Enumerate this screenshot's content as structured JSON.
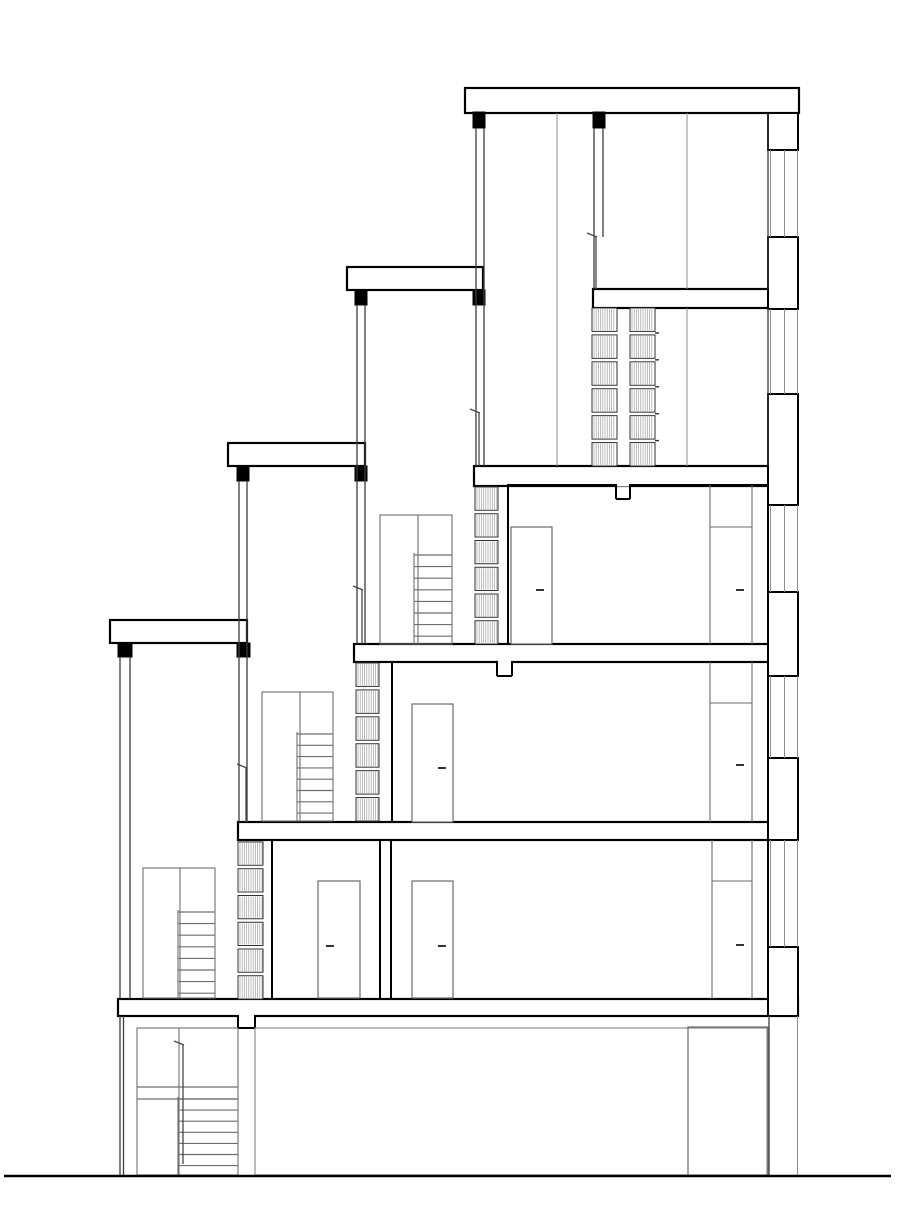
{
  "drawing": {
    "canvas": {
      "width": 912,
      "height": 1232,
      "background": "#ffffff"
    },
    "palette": {
      "heavy": "#000000",
      "medium": "#3c3c3c",
      "light": "#8e8e8e",
      "door": "#6b6b6b",
      "stair": "#6f6f6f",
      "hatch": "#9a9a9a",
      "hatch_frame": "#2f2f2f",
      "handle": "#333333",
      "rail": "#474747"
    },
    "ground_line": {
      "x1": 4,
      "x2": 891,
      "y": 1176,
      "weight": 2.6
    },
    "slabs": [
      {
        "name": "roof-slab",
        "x": 465,
        "y": 88,
        "w": 334,
        "h": 25
      },
      {
        "name": "floor-slab-4",
        "x": 593,
        "y": 289,
        "w": 177,
        "h": 19
      },
      {
        "name": "floor-slab-3",
        "x": 474,
        "y": 466,
        "w": 296,
        "h": 20
      },
      {
        "name": "floor-slab-2",
        "x": 354,
        "y": 644,
        "w": 416,
        "h": 18
      },
      {
        "name": "floor-slab-1",
        "x": 238,
        "y": 822,
        "w": 532,
        "h": 18
      },
      {
        "name": "floor-slab-0",
        "x": 118,
        "y": 999,
        "w": 680,
        "h": 17
      }
    ],
    "parapet_caps": [
      {
        "name": "terrace-parapet-2",
        "x": 347,
        "y": 267,
        "w": 136,
        "h": 23
      },
      {
        "name": "terrace-parapet-3",
        "x": 228,
        "y": 443,
        "w": 137,
        "h": 23
      },
      {
        "name": "terrace-parapet-4",
        "x": 110,
        "y": 620,
        "w": 137,
        "h": 23
      }
    ],
    "posts": [
      {
        "x": 473,
        "y": 112,
        "w": 12,
        "h": 16
      },
      {
        "x": 593,
        "y": 112,
        "w": 12,
        "h": 16
      },
      {
        "x": 355,
        "y": 290,
        "w": 12,
        "h": 15
      },
      {
        "x": 473,
        "y": 290,
        "w": 12,
        "h": 15
      },
      {
        "x": 237,
        "y": 466,
        "w": 12,
        "h": 15
      },
      {
        "x": 355,
        "y": 466,
        "w": 12,
        "h": 15
      },
      {
        "x": 118,
        "y": 643,
        "w": 14,
        "h": 14
      },
      {
        "x": 237,
        "y": 643,
        "w": 13,
        "h": 14
      }
    ],
    "wall_lines": [
      {
        "x": 476,
        "y1": 128,
        "y2": 466,
        "c": "medium"
      },
      {
        "x": 484,
        "y1": 128,
        "y2": 466,
        "c": "medium"
      },
      {
        "x": 594,
        "y1": 128,
        "y2": 289,
        "c": "medium"
      },
      {
        "x": 603,
        "y1": 128,
        "y2": 237,
        "c": "medium"
      },
      {
        "x": 357,
        "y1": 305,
        "y2": 644,
        "c": "medium"
      },
      {
        "x": 365,
        "y1": 305,
        "y2": 644,
        "c": "medium"
      },
      {
        "x": 239,
        "y1": 481,
        "y2": 822,
        "c": "medium"
      },
      {
        "x": 247,
        "y1": 481,
        "y2": 822,
        "c": "medium"
      },
      {
        "x": 120,
        "y1": 657,
        "y2": 999,
        "c": "medium"
      },
      {
        "x": 130,
        "y1": 657,
        "y2": 999,
        "c": "medium"
      },
      {
        "x": 120,
        "y1": 1016,
        "y2": 1175,
        "c": "medium"
      },
      {
        "x": 123.5,
        "y1": 1016,
        "y2": 1175,
        "c": "medium"
      },
      {
        "x": 769,
        "y1": 1016,
        "y2": 1175,
        "c": "medium"
      },
      {
        "x": 797.5,
        "y1": 1016,
        "y2": 1175,
        "c": "light"
      },
      {
        "x": 557,
        "y1": 113,
        "y2": 466,
        "c": "light"
      },
      {
        "x": 687,
        "y1": 113,
        "y2": 289,
        "c": "light"
      },
      {
        "x": 687,
        "y1": 308,
        "y2": 466,
        "c": "light"
      },
      {
        "x": 768,
        "y1": 113,
        "y2": 289,
        "c": "medium"
      },
      {
        "x": 768,
        "y1": 308,
        "y2": 466,
        "c": "medium"
      }
    ],
    "facade": {
      "x": 768,
      "w": 30,
      "blocks": [
        {
          "y1": 113,
          "y2": 150
        },
        {
          "y1": 237,
          "y2": 309
        },
        {
          "y1": 394,
          "y2": 505
        },
        {
          "y1": 592,
          "y2": 676
        },
        {
          "y1": 758,
          "y2": 840
        },
        {
          "y1": 947,
          "y2": 1016
        }
      ],
      "windows": [
        {
          "y1": 150,
          "y2": 237
        },
        {
          "y1": 309,
          "y2": 394
        },
        {
          "y1": 505,
          "y2": 592
        },
        {
          "y1": 676,
          "y2": 758
        },
        {
          "y1": 840,
          "y2": 947
        }
      ],
      "window_line_x": [
        770.5,
        784.5,
        797.5
      ]
    },
    "room_boxes": [
      {
        "name": "room-outline-l3",
        "x": 508,
        "y": 485,
        "w": 260,
        "h": 159,
        "notch": {
          "x": 616,
          "w": 14,
          "d": 14
        }
      },
      {
        "name": "room-outline-l2",
        "x": 392,
        "y": 662,
        "w": 376,
        "h": 160,
        "notch": {
          "x": 497,
          "w": 15,
          "d": 14
        }
      },
      {
        "name": "room-outline-l1-left",
        "x": 272,
        "y": 840,
        "w": 108,
        "h": 159
      },
      {
        "name": "room-outline-l1-right",
        "x": 391,
        "y": 840,
        "w": 377,
        "h": 159
      }
    ],
    "ceiling_notch": {
      "x": 238,
      "w": 17,
      "d": 12,
      "y": 1016
    },
    "doors": [
      {
        "x": 511,
        "y": 527,
        "w": 41,
        "h": 117,
        "handle_cx": 540,
        "handle_y": 590
      },
      {
        "x": 412,
        "y": 704,
        "w": 41,
        "h": 118,
        "handle_cx": 442,
        "handle_y": 768
      },
      {
        "x": 318,
        "y": 881,
        "w": 42,
        "h": 117,
        "handle_cx": 330,
        "handle_y": 946
      },
      {
        "x": 412,
        "y": 881,
        "w": 41,
        "h": 117,
        "handle_cx": 442,
        "handle_y": 946
      }
    ],
    "wardrobes": [
      {
        "x1": 710,
        "x2": 752,
        "top": 485,
        "mid": 527,
        "bottom": 644,
        "handle_cx": 740,
        "handle_y": 590
      },
      {
        "x1": 710,
        "x2": 752,
        "top": 662,
        "mid": 703,
        "bottom": 822,
        "handle_cx": 740,
        "handle_y": 765
      },
      {
        "x1": 712,
        "x2": 752,
        "top": 840,
        "mid": 881,
        "bottom": 999,
        "handle_cx": 740,
        "handle_y": 945
      }
    ],
    "stairs": [
      {
        "box": {
          "x": 137,
          "y": 1028,
          "w": 101,
          "h": 147
        },
        "divider_x": 179,
        "landing_lines": [
          1087,
          1099
        ],
        "steps": {
          "x1": 178,
          "x2": 238,
          "y1": 1099,
          "n": 7,
          "dy": 11.1
        },
        "rail": {
          "x": 183,
          "y1": 1045,
          "y2": 1164
        }
      },
      {
        "box": {
          "x": 143,
          "y": 868,
          "w": 72,
          "h": 130
        },
        "divider_x": 180,
        "steps": {
          "x1": 178,
          "x2": 215,
          "y1": 912,
          "n": 8,
          "dy": 11.6
        }
      },
      {
        "box": {
          "x": 262,
          "y": 692,
          "w": 71,
          "h": 129
        },
        "divider_x": 300,
        "steps": {
          "x1": 297,
          "x2": 333,
          "y1": 734,
          "n": 8,
          "dy": 11.3
        }
      },
      {
        "box": {
          "x": 380,
          "y": 515,
          "w": 72,
          "h": 129
        },
        "divider_x": 418,
        "steps": {
          "x1": 414,
          "x2": 452,
          "y1": 555,
          "n": 8,
          "dy": 11.6
        }
      }
    ],
    "balustrades": [
      {
        "x": 592,
        "y": 308,
        "w": 25,
        "h": 158,
        "segments": 6
      },
      {
        "x": 630,
        "y": 308,
        "w": 25,
        "h": 158,
        "segments": 6,
        "tabs": true
      },
      {
        "x": 475,
        "y": 487,
        "w": 23,
        "h": 157,
        "segments": 6
      },
      {
        "x": 356,
        "y": 663,
        "w": 23,
        "h": 158,
        "segments": 6
      },
      {
        "x": 238,
        "y": 842,
        "w": 25,
        "h": 157,
        "segments": 6
      }
    ],
    "handrails": [
      {
        "x": 596,
        "y1": 237,
        "y2": 289
      },
      {
        "x": 479,
        "y1": 413,
        "y2": 466
      },
      {
        "x": 362,
        "y1": 590,
        "y2": 644
      },
      {
        "x": 246,
        "y1": 768,
        "y2": 822
      }
    ],
    "ground_floor": {
      "hall_box": {
        "x": 255,
        "y": 1028,
        "w": 512,
        "h": 147
      },
      "opening": {
        "x": 688,
        "y": 1027,
        "w": 80,
        "h": 149
      }
    }
  }
}
